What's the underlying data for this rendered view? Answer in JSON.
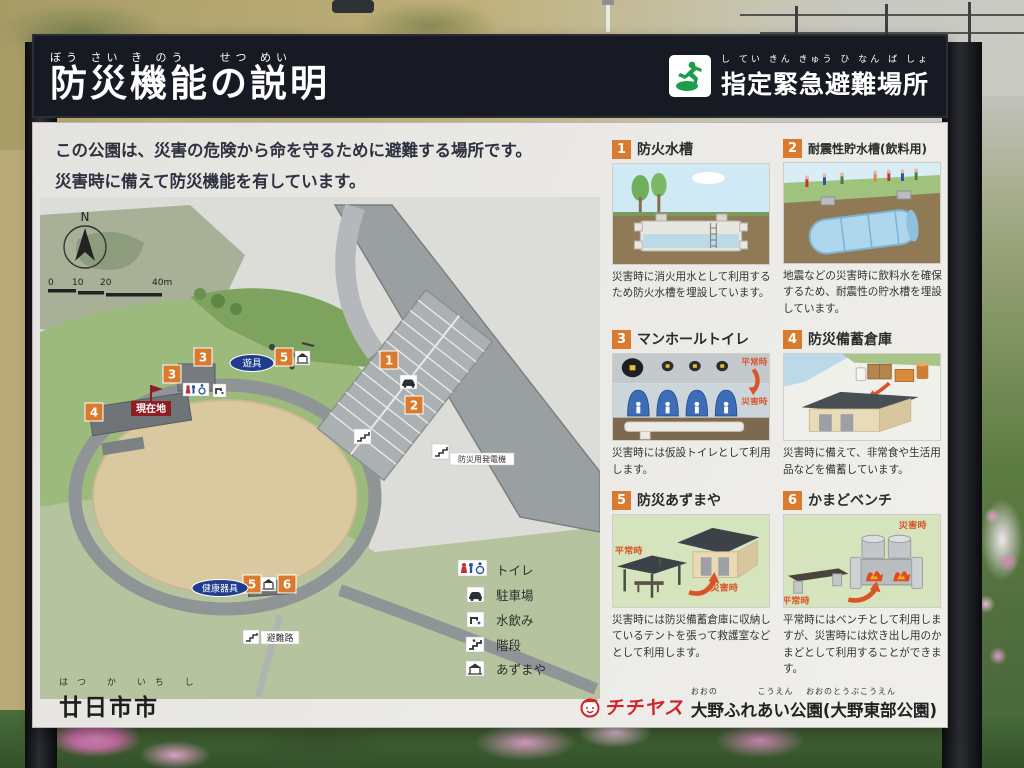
{
  "header": {
    "title": "防災機能の説明",
    "title_furigana": "ぼう さい き のう　　せつ めい",
    "evacuation": {
      "label": "指定緊急避難場所",
      "furigana": "し てい きん きゅう ひ なん ば しょ"
    }
  },
  "intro": {
    "line1": "この公園は、災害の危険から命を守るために避難する場所です。",
    "line2": "災害時に備えて防災機能を有しています。"
  },
  "map": {
    "compass": "N",
    "scale": [
      "0",
      "10",
      "20",
      "40m"
    ],
    "markers": [
      "1",
      "2",
      "3",
      "4",
      "5",
      "6"
    ],
    "labels": {
      "playground": "遊具",
      "current_location": "現在地",
      "health_equipment": "健康器具",
      "evacuation_route": "避難路",
      "generator": "防災用発電機"
    },
    "legend": [
      {
        "icon": "toilet-icon",
        "label": "トイレ"
      },
      {
        "icon": "parking-icon",
        "label": "駐車場"
      },
      {
        "icon": "drinking-water-icon",
        "label": "水飲み"
      },
      {
        "icon": "stairs-icon",
        "label": "階段"
      },
      {
        "icon": "gazebo-icon",
        "label": "あずまや"
      }
    ],
    "city": {
      "name": "廿日市市",
      "furigana": "はつ か いち し"
    }
  },
  "panels": [
    {
      "number": "1",
      "title": "防火水槽",
      "description": "災害時に消火用水として利用するため防火水槽を埋設しています。"
    },
    {
      "number": "2",
      "title": "耐震性貯水槽(飲料用)",
      "description": "地震などの災害時に飲料水を確保するため、耐震性の貯水槽を埋設しています。"
    },
    {
      "number": "3",
      "title": "マンホールトイレ",
      "description": "災害時には仮設トイレとして利用します。",
      "normal_label": "平常時",
      "disaster_label": "災害時"
    },
    {
      "number": "4",
      "title": "防災備蓄倉庫",
      "description": "災害時に備えて、非常食や生活用品などを備蓄しています。"
    },
    {
      "number": "5",
      "title": "防災あずまや",
      "description": "災害時には防災備蓄倉庫に収納しているテントを張って救護室などとして利用します。",
      "normal_label": "平常時",
      "disaster_label": "災害時"
    },
    {
      "number": "6",
      "title": "かまどベンチ",
      "description": "平常時にはベンチとして利用しますが、災害時には炊き出し用のかまどとして利用することができます。",
      "normal_label": "平常時",
      "disaster_label": "災害時"
    }
  ],
  "footer": {
    "brand": "チチヤス",
    "park_name": "大野ふれあい公園(大野東部公園)",
    "park_furigana": "おおの　　　　 こうえん　 おおのとうぶこうえん"
  },
  "colors": {
    "header_bg": "#171a23",
    "accent_orange": "#d97a2e",
    "map_label_blue": "#1f3d8c",
    "current_location_red": "#8f1d23",
    "alert_red": "#d9542b",
    "brand_red": "#d1232a",
    "evacuation_green": "#1e9e4b"
  }
}
